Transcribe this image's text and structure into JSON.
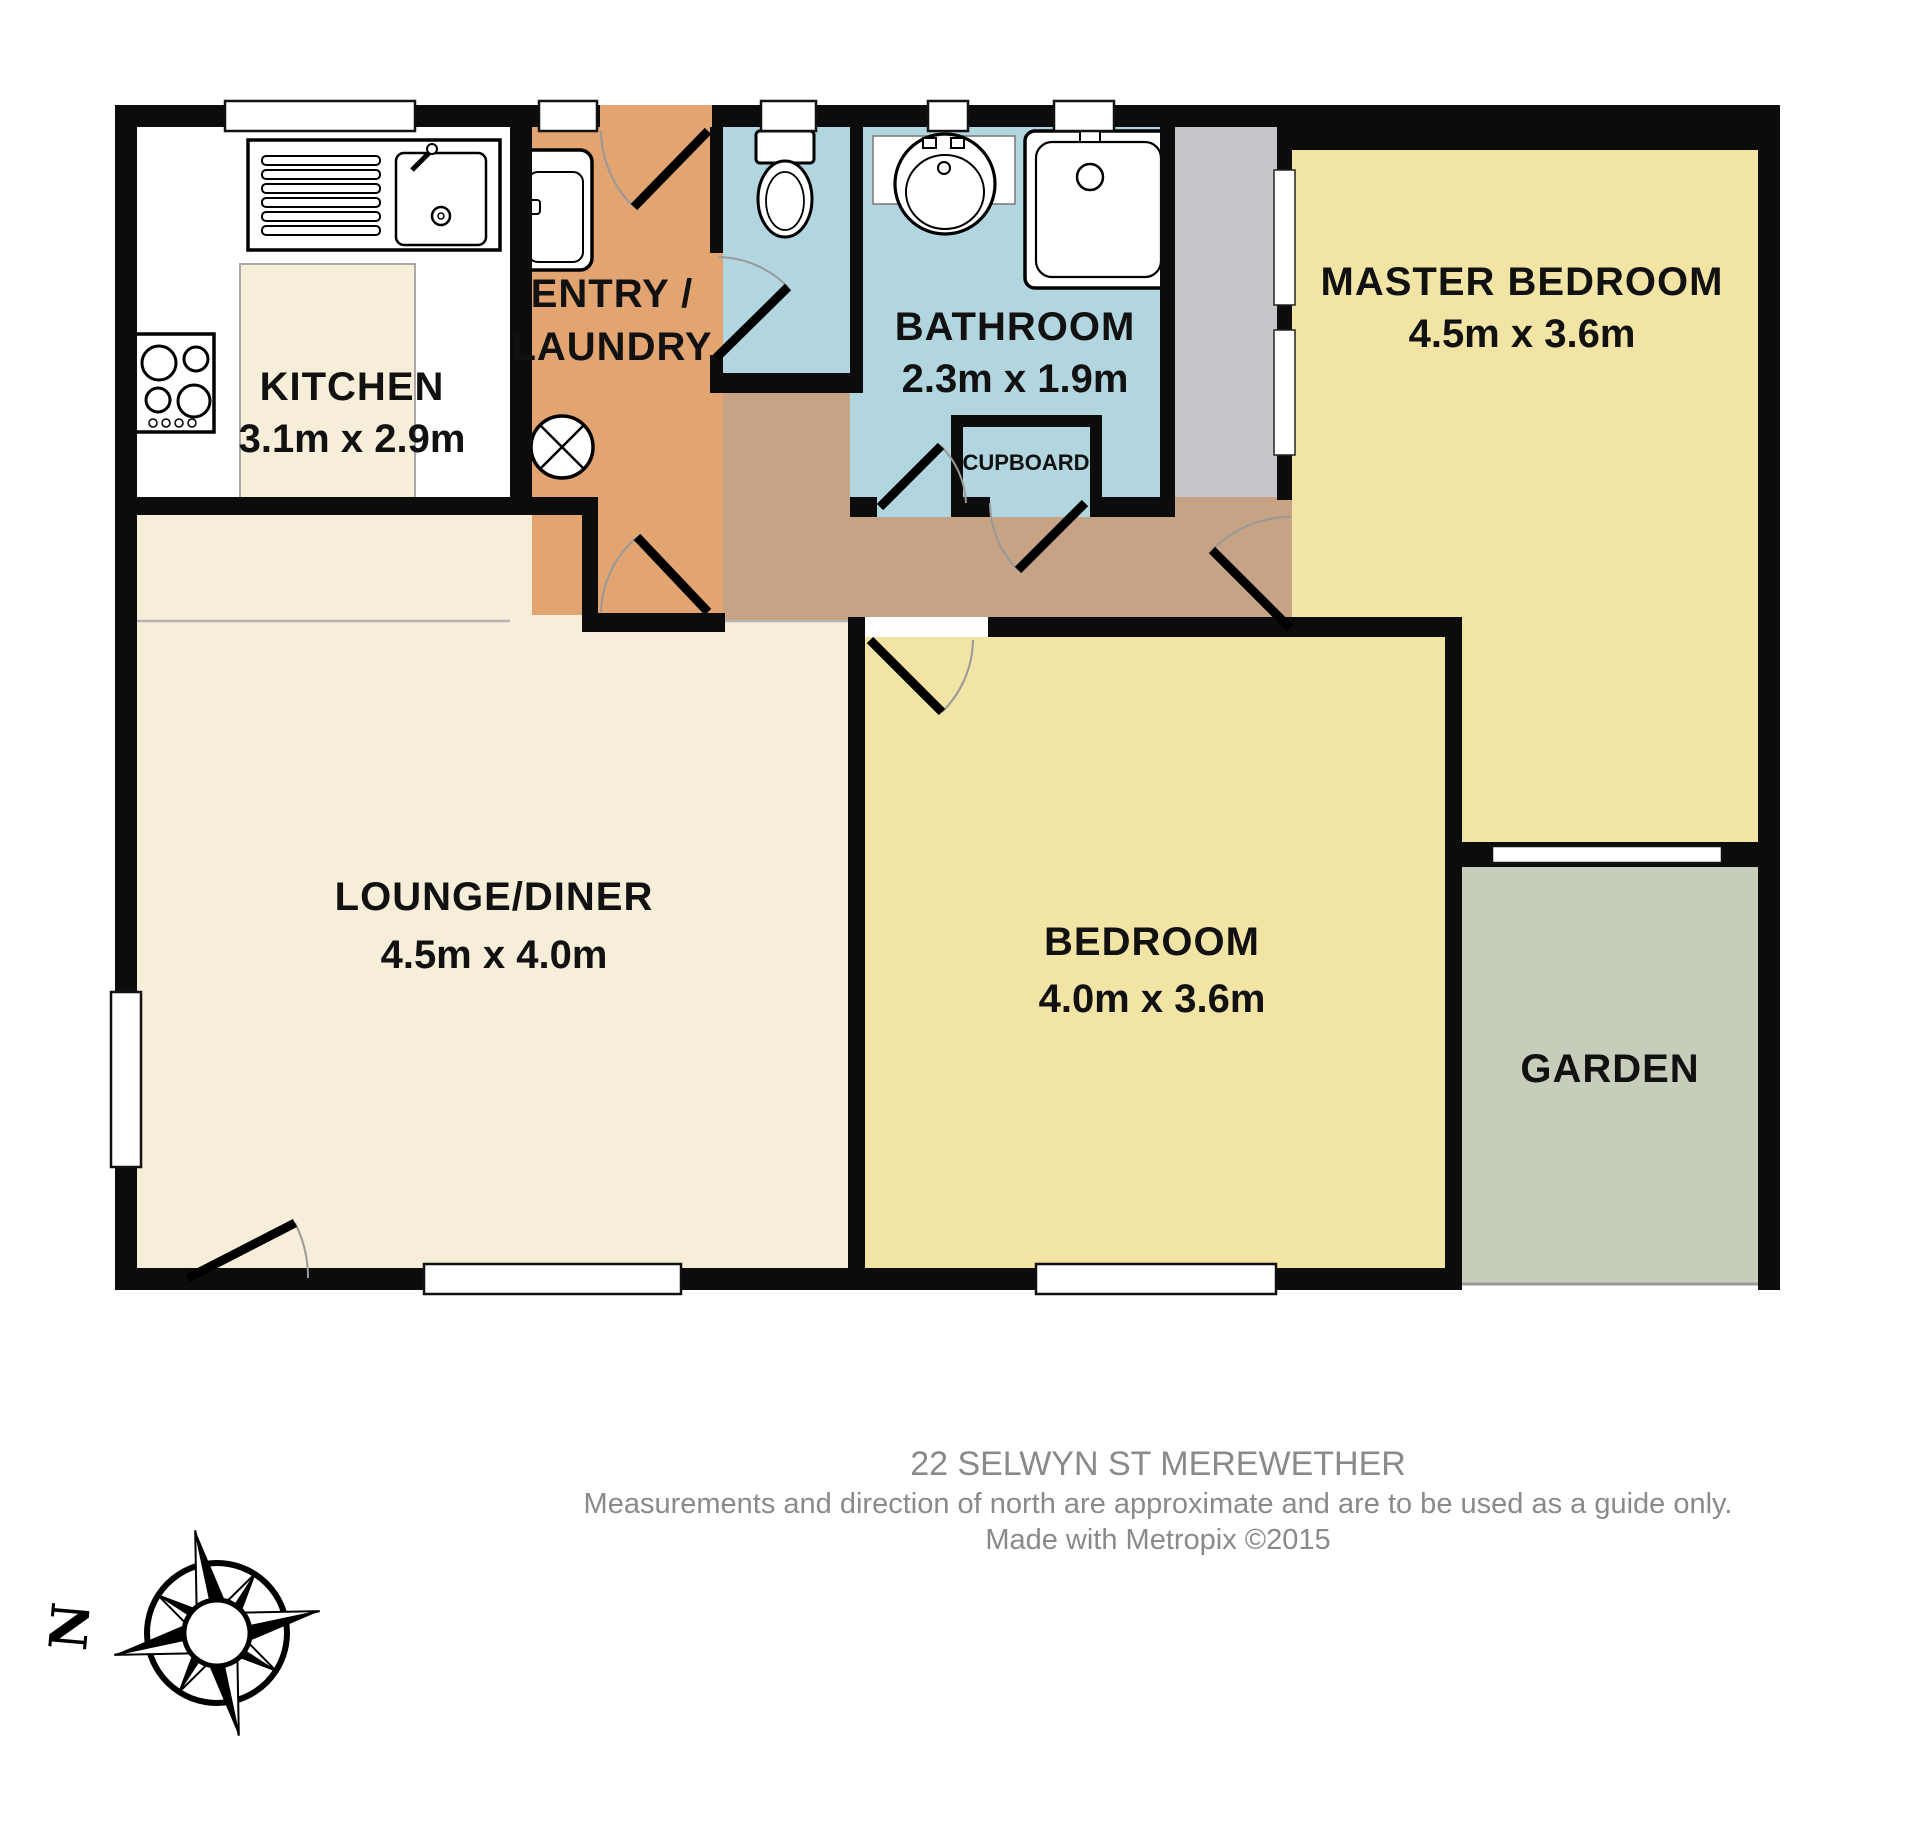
{
  "title": "22 SELWYN ST MEREWETHER floor plan",
  "colors": {
    "wall": "#0c0c0c",
    "kitchen_floor": "#ffffff",
    "cream": "#f6eed8",
    "bedroom_yellow": "#f2e4a4",
    "entry_orange": "#e2a572",
    "hallway_tan": "#c6a384",
    "bathroom_blue": "#b2d6e0",
    "cupboard_grey": "#c7c6ca",
    "garden_green": "#c6cdba",
    "door_arc": "#999999",
    "fixture_outline": "#000000",
    "text": "#111111",
    "footer_text": "#8a8a8a"
  },
  "rooms": {
    "kitchen": {
      "label": "KITCHEN",
      "dims": "3.1m x 2.9m"
    },
    "entry_laundry": {
      "label_line1": "ENTRY /",
      "label_line2": "LAUNDRY"
    },
    "bathroom": {
      "label": "BATHROOM",
      "dims": "2.3m x 1.9m"
    },
    "cupboard": {
      "label": "CUPBOARD"
    },
    "master_bedroom": {
      "label": "MASTER BEDROOM",
      "dims": "4.5m x 3.6m"
    },
    "bedroom": {
      "label": "BEDROOM",
      "dims": "4.0m x 3.6m"
    },
    "lounge_diner": {
      "label": "LOUNGE/DINER",
      "dims": "4.5m x 4.0m"
    },
    "garden": {
      "label": "GARDEN"
    }
  },
  "footer": {
    "address": "22 SELWYN ST MEREWETHER",
    "disclaimer": "Measurements and direction of north are approximate and are to be used as a guide only.",
    "credit": "Made with Metropix ©2015"
  },
  "compass": {
    "north_label": "N"
  }
}
